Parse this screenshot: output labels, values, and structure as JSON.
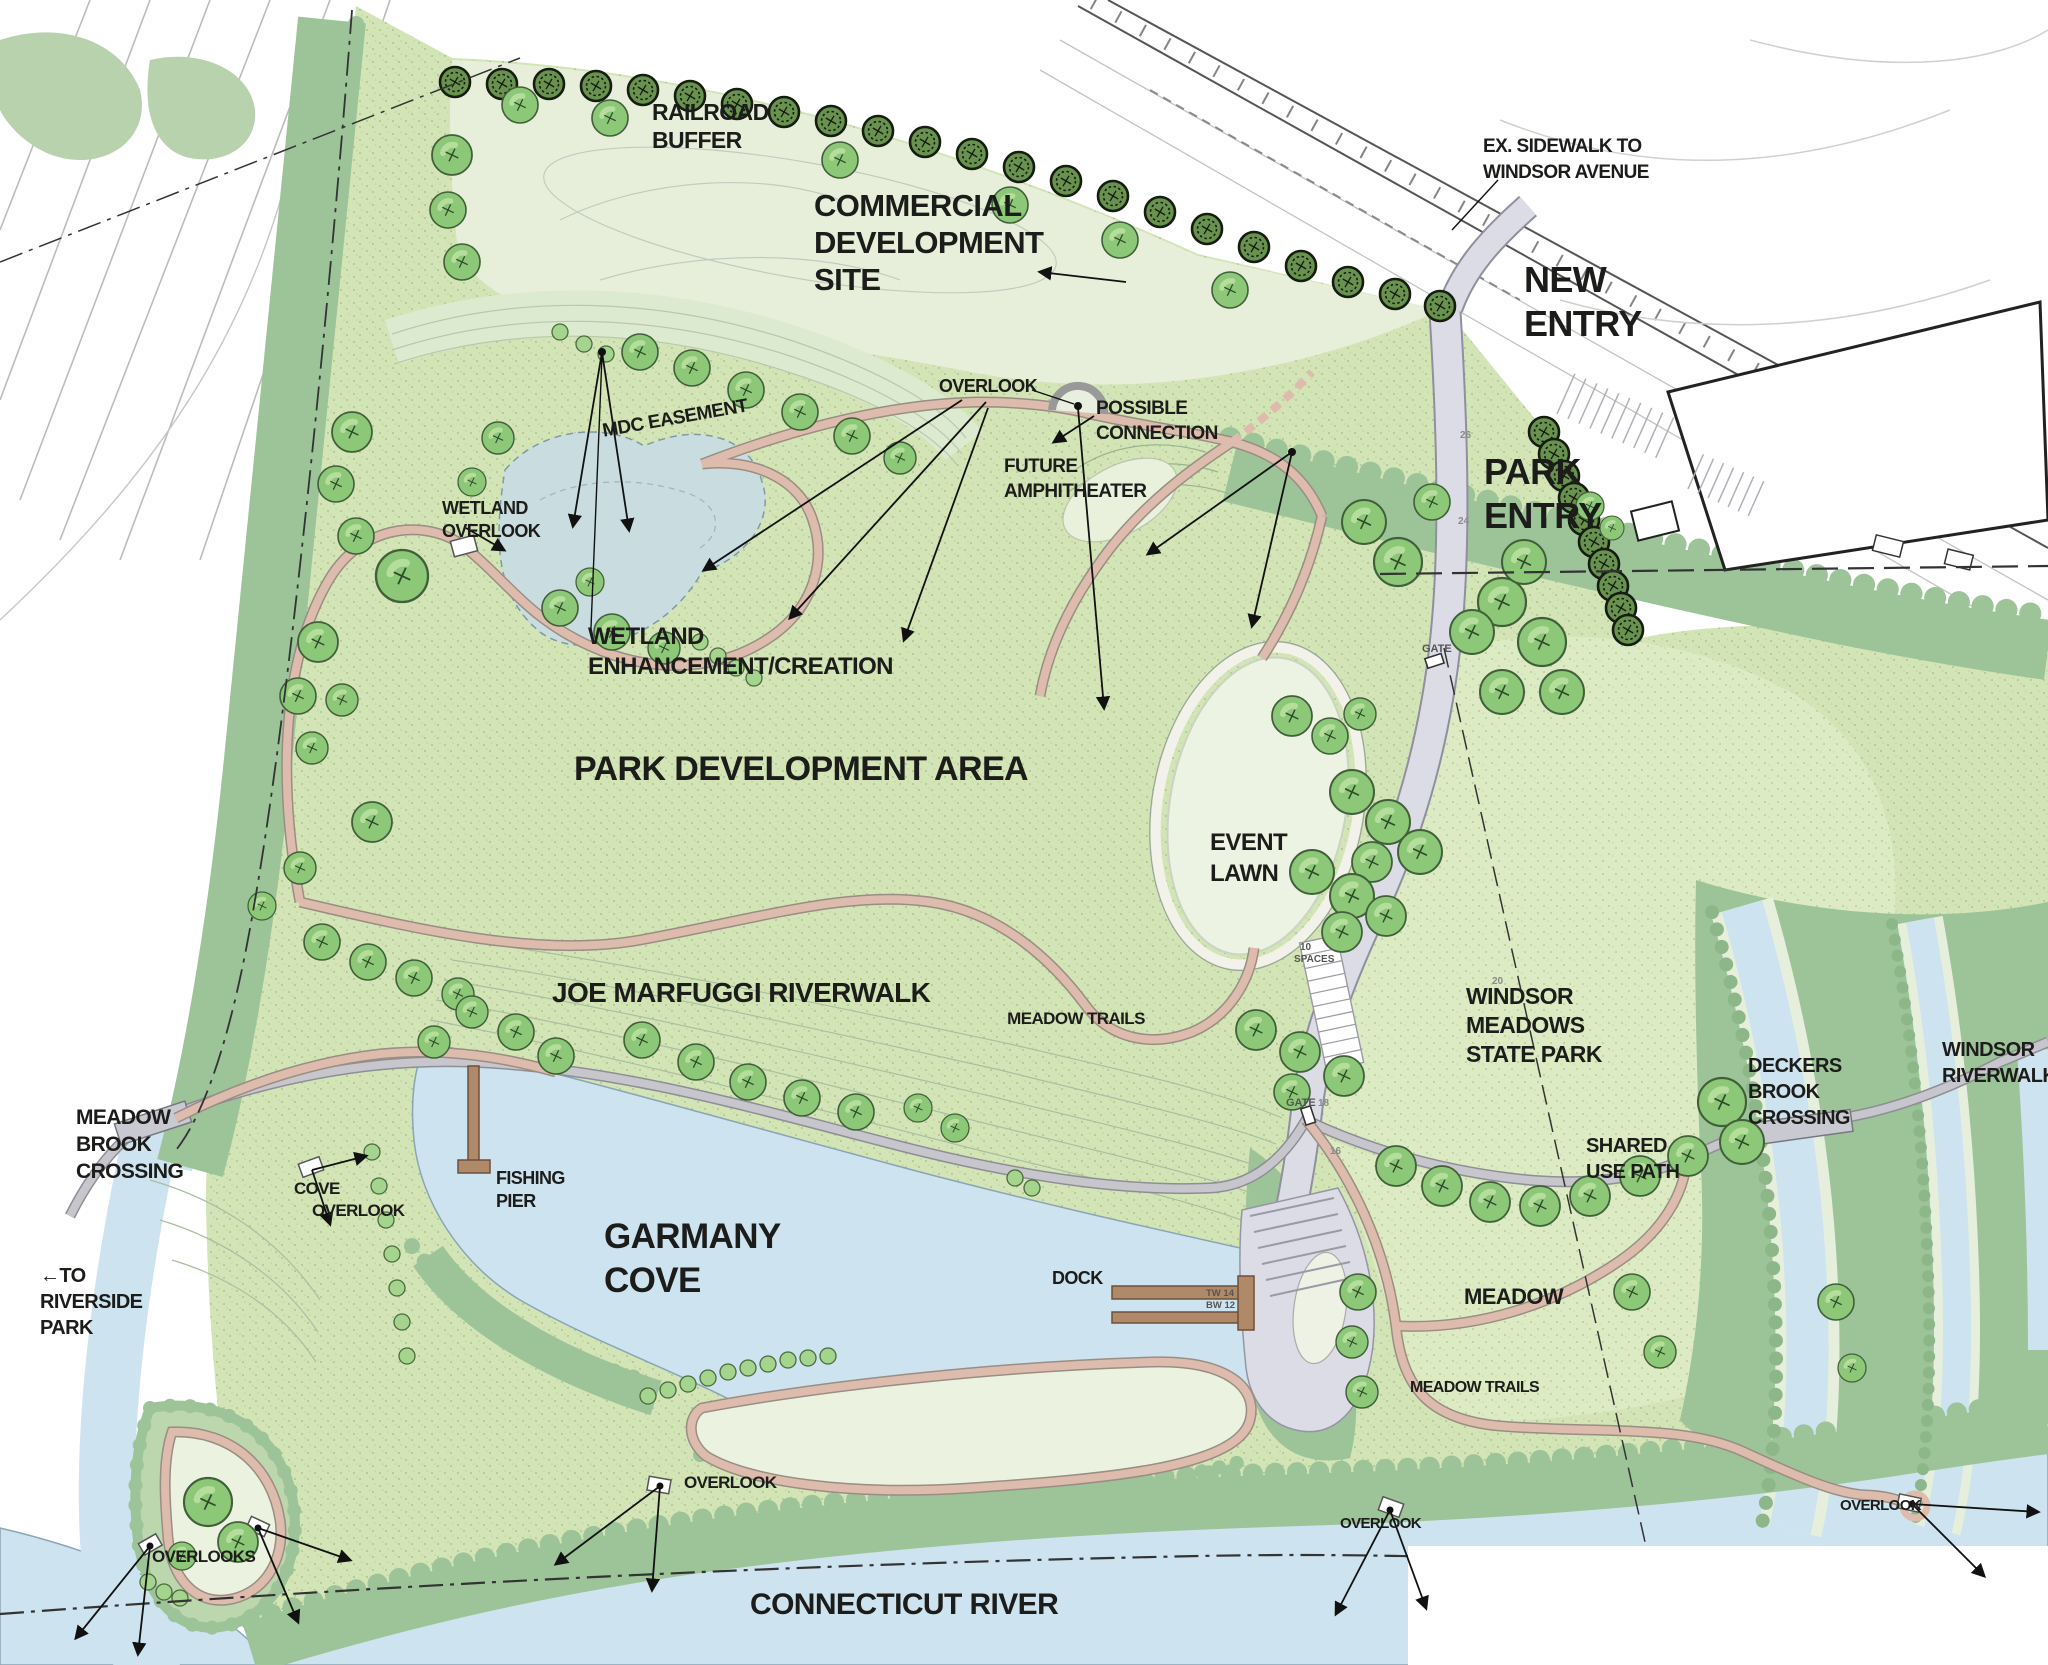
{
  "labels": {
    "railroad_buffer": [
      "RAILROAD",
      "BUFFER"
    ],
    "commercial_site": [
      "COMMERCIAL",
      "DEVELOPMENT",
      "SITE"
    ],
    "ex_sidewalk": [
      "EX. SIDEWALK TO",
      "WINDSOR AVENUE"
    ],
    "new_entry": [
      "NEW",
      "ENTRY"
    ],
    "park_entry": [
      "PARK",
      "ENTRY"
    ],
    "overlook_top": "OVERLOOK",
    "possible_connection": [
      "POSSIBLE",
      "CONNECTION"
    ],
    "mdc_easement": "MDC EASEMENT",
    "future_amphitheater": [
      "FUTURE",
      "AMPHITHEATER"
    ],
    "wetland_overlook": [
      "WETLAND",
      "OVERLOOK"
    ],
    "wetland_enhancement": [
      "WETLAND",
      "ENHANCEMENT/CREATION"
    ],
    "park_development_area": "PARK DEVELOPMENT AREA",
    "event_lawn": [
      "EVENT",
      "LAWN"
    ],
    "joe_marfuggi_riverwalk": "JOE MARFUGGI RIVERWALK",
    "meadow_trails_west": "MEADOW TRAILS",
    "meadow_trails_east": "MEADOW TRAILS",
    "windsor_meadows_state_park": [
      "WINDSOR",
      "MEADOWS",
      "STATE PARK"
    ],
    "deckers_brook_crossing": [
      "DECKERS",
      "BROOK",
      "CROSSING"
    ],
    "windsor_riverwalk": [
      "WINDSOR",
      "RIVERWALK"
    ],
    "shared_use_path": [
      "SHARED",
      "USE PATH"
    ],
    "meadow_brook_crossing": [
      "MEADOW",
      "BROOK",
      "CROSSING"
    ],
    "to_riverside_park": [
      "←TO",
      "RIVERSIDE",
      "PARK"
    ],
    "cove_overlook": [
      "COVE",
      "OVERLOOK"
    ],
    "fishing_pier": [
      "FISHING",
      "PIER"
    ],
    "garmany_cove": [
      "GARMANY",
      "COVE"
    ],
    "dock": "DOCK",
    "meadow": "MEADOW",
    "overlook_lawn": "OVERLOOK",
    "overlook_boat": "OVERLOOK",
    "overlook_east": "OVERLOOK",
    "overlooks_sw": "OVERLOOKS",
    "connecticut_river": "CONNECTICUT RIVER",
    "gate_north": "GATE",
    "gate_south": "GATE",
    "parking_spaces": [
      "10",
      "SPACES"
    ],
    "wall_tags": [
      "TW 14",
      "BW 12"
    ],
    "contour_tags": [
      "26",
      "24",
      "20",
      "18",
      "16"
    ]
  },
  "colors": {
    "paper": "#ffffff",
    "park_green": "#d3e4b7",
    "meadow_green": "#dcebc4",
    "lawn": "#edf3e2",
    "commercial": "#e7efdb",
    "forest": "#9dc399",
    "water": "#cde3f0",
    "pond": "#c9dde0",
    "trail_pink": "#ddbcae",
    "road_gray": "#dcdce6",
    "path_gray": "#bcbcc4",
    "ink": "#1c1c1a",
    "tree": "#8cc878",
    "tree_dark": "#69924f"
  }
}
